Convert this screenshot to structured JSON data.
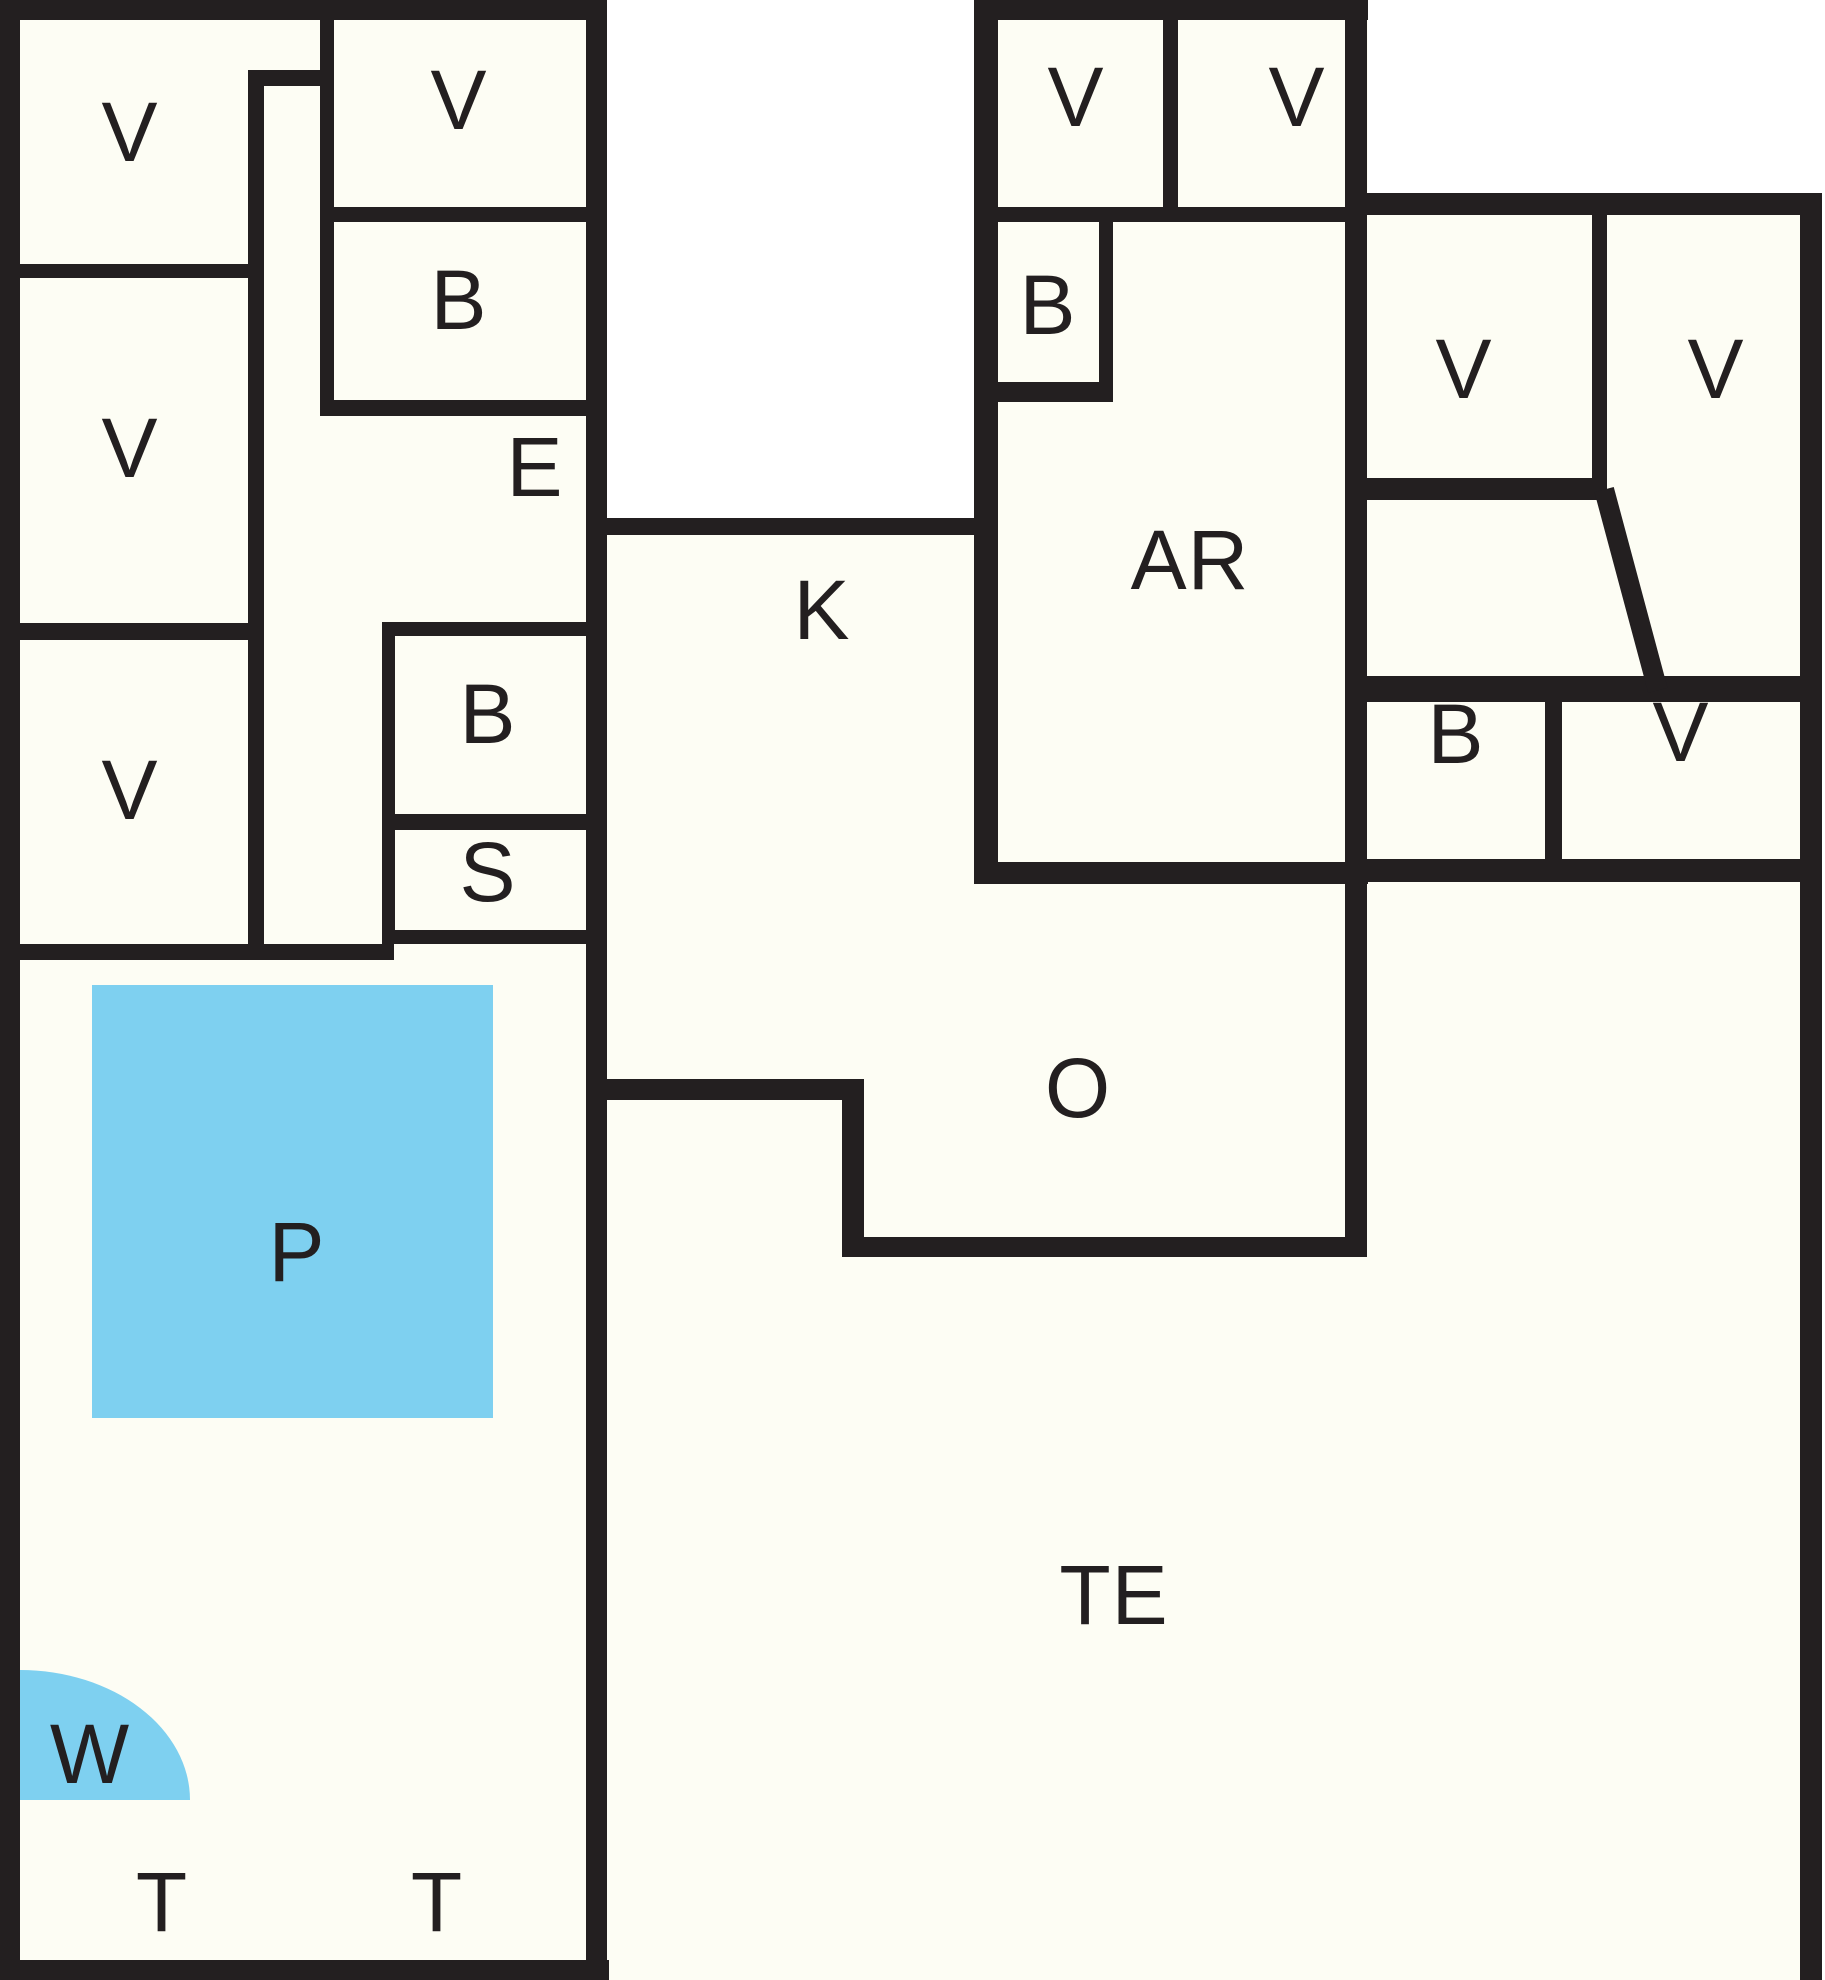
{
  "floor_plan": {
    "width": 1825,
    "height": 1980,
    "colors": {
      "wall": "#231f20",
      "room": "#fdfdf4",
      "outside": "#ffffff",
      "water": "#7ed0f0",
      "label": "#231f20"
    },
    "fills": [
      {
        "name": "left-block-area",
        "x": 0,
        "y": 0,
        "w": 607,
        "h": 1980
      },
      {
        "name": "k-o-area",
        "x": 607,
        "y": 535,
        "w": 738,
        "h": 722
      },
      {
        "name": "center-block-area",
        "x": 974,
        "y": 0,
        "w": 394,
        "h": 884
      },
      {
        "name": "right-wing-area",
        "x": 1345,
        "y": 193,
        "w": 477,
        "h": 689
      },
      {
        "name": "terrace-area",
        "x": 607,
        "y": 1079,
        "w": 1215,
        "h": 901
      },
      {
        "name": "terrace-right-area",
        "x": 1345,
        "y": 862,
        "w": 477,
        "h": 1118
      }
    ],
    "walls": [
      {
        "name": "outer-left",
        "x": 0,
        "y": 0,
        "w": 20,
        "h": 1980
      },
      {
        "name": "outer-top-left",
        "x": 0,
        "y": 0,
        "w": 607,
        "h": 20
      },
      {
        "name": "outer-top-center",
        "x": 974,
        "y": 0,
        "w": 394,
        "h": 20
      },
      {
        "name": "outer-right",
        "x": 1800,
        "y": 193,
        "w": 22,
        "h": 1787
      },
      {
        "name": "outer-bottom-left",
        "x": 0,
        "y": 1960,
        "w": 609,
        "h": 20
      },
      {
        "name": "main-spine",
        "x": 586,
        "y": 0,
        "w": 21,
        "h": 1980
      },
      {
        "name": "corridor-cap",
        "x": 248,
        "y": 70,
        "w": 84,
        "h": 16
      },
      {
        "name": "corridor-left",
        "x": 248,
        "y": 70,
        "w": 16,
        "h": 890
      },
      {
        "name": "corridor-right",
        "x": 320,
        "y": 20,
        "w": 14,
        "h": 396
      },
      {
        "name": "v1-bottom",
        "x": 17,
        "y": 264,
        "w": 246,
        "h": 14
      },
      {
        "name": "v2-bottom",
        "x": 17,
        "y": 623,
        "w": 246,
        "h": 17
      },
      {
        "name": "pool-room-top",
        "x": 17,
        "y": 944,
        "w": 377,
        "h": 16
      },
      {
        "name": "vmid-bottom",
        "x": 320,
        "y": 207,
        "w": 266,
        "h": 15
      },
      {
        "name": "bmid-bottom",
        "x": 320,
        "y": 400,
        "w": 287,
        "h": 16
      },
      {
        "name": "blower-top",
        "x": 382,
        "y": 622,
        "w": 225,
        "h": 14
      },
      {
        "name": "b-s-divider",
        "x": 382,
        "y": 814,
        "w": 225,
        "h": 16
      },
      {
        "name": "s-bottom",
        "x": 382,
        "y": 930,
        "w": 225,
        "h": 14
      },
      {
        "name": "b-s-left",
        "x": 382,
        "y": 622,
        "w": 13,
        "h": 322
      },
      {
        "name": "void-bottom",
        "x": 607,
        "y": 518,
        "w": 370,
        "h": 17
      },
      {
        "name": "ar-block-left",
        "x": 974,
        "y": 0,
        "w": 24,
        "h": 884
      },
      {
        "name": "va-vb-divider",
        "x": 1163,
        "y": 20,
        "w": 15,
        "h": 188
      },
      {
        "name": "center-v-bottom",
        "x": 998,
        "y": 207,
        "w": 347,
        "h": 15
      },
      {
        "name": "small-b-right",
        "x": 1099,
        "y": 222,
        "w": 14,
        "h": 160
      },
      {
        "name": "small-b-bottom",
        "x": 998,
        "y": 382,
        "w": 115,
        "h": 20
      },
      {
        "name": "ar-bottom",
        "x": 998,
        "y": 862,
        "w": 370,
        "h": 22
      },
      {
        "name": "block-right",
        "x": 1345,
        "y": 0,
        "w": 22,
        "h": 1257
      },
      {
        "name": "wing-top",
        "x": 1345,
        "y": 193,
        "w": 477,
        "h": 22
      },
      {
        "name": "wing-v-divider",
        "x": 1592,
        "y": 215,
        "w": 15,
        "h": 271
      },
      {
        "name": "wing-vleft-bottom",
        "x": 1345,
        "y": 478,
        "w": 262,
        "h": 22
      },
      {
        "name": "wing-row-top",
        "x": 1345,
        "y": 676,
        "w": 477,
        "h": 26
      },
      {
        "name": "wing-b-v-divider",
        "x": 1545,
        "y": 702,
        "w": 17,
        "h": 160
      },
      {
        "name": "wing-row-bottom",
        "x": 1345,
        "y": 859,
        "w": 477,
        "h": 23
      },
      {
        "name": "k-bottom-step",
        "x": 586,
        "y": 1079,
        "w": 278,
        "h": 21
      },
      {
        "name": "step-vertical",
        "x": 842,
        "y": 1100,
        "w": 22,
        "h": 157
      },
      {
        "name": "o-te-bottom",
        "x": 842,
        "y": 1237,
        "w": 525,
        "h": 20
      }
    ],
    "diagonal_wall": {
      "name": "wing-diagonal",
      "x": 1621,
      "y": 486,
      "w": 20,
      "h": 208,
      "rotate_deg": -15
    },
    "pool": {
      "label": "P",
      "x": 92,
      "y": 985,
      "w": 401,
      "h": 433,
      "label_x": 297,
      "label_y": 1252
    },
    "whirlpool": {
      "label": "W",
      "x": 20,
      "y": 1670,
      "w": 170,
      "h": 130,
      "label_x": 90,
      "label_y": 1754
    },
    "labels": [
      {
        "id": "room-label-v1",
        "text": "V",
        "x": 130,
        "y": 132
      },
      {
        "id": "room-label-v2",
        "text": "V",
        "x": 130,
        "y": 448
      },
      {
        "id": "room-label-v3",
        "text": "V",
        "x": 130,
        "y": 790
      },
      {
        "id": "room-label-v-mid",
        "text": "V",
        "x": 459,
        "y": 100
      },
      {
        "id": "room-label-b-mid",
        "text": "B",
        "x": 459,
        "y": 300
      },
      {
        "id": "room-label-e",
        "text": "E",
        "x": 535,
        "y": 467
      },
      {
        "id": "room-label-b-lower",
        "text": "B",
        "x": 488,
        "y": 714
      },
      {
        "id": "room-label-s",
        "text": "S",
        "x": 488,
        "y": 872
      },
      {
        "id": "room-label-k",
        "text": "K",
        "x": 822,
        "y": 610
      },
      {
        "id": "room-label-v-center-1",
        "text": "V",
        "x": 1076,
        "y": 97
      },
      {
        "id": "room-label-v-center-2",
        "text": "V",
        "x": 1297,
        "y": 97
      },
      {
        "id": "room-label-b-ar",
        "text": "B",
        "x": 1048,
        "y": 305
      },
      {
        "id": "room-label-ar",
        "text": "AR",
        "x": 1190,
        "y": 560
      },
      {
        "id": "room-label-v-wing-left",
        "text": "V",
        "x": 1464,
        "y": 369
      },
      {
        "id": "room-label-v-wing-right",
        "text": "V",
        "x": 1716,
        "y": 369
      },
      {
        "id": "room-label-b-wing",
        "text": "B",
        "x": 1456,
        "y": 734
      },
      {
        "id": "room-label-v-wing-row",
        "text": "V",
        "x": 1681,
        "y": 732
      },
      {
        "id": "room-label-o",
        "text": "O",
        "x": 1078,
        "y": 1088
      },
      {
        "id": "room-label-te",
        "text": "TE",
        "x": 1114,
        "y": 1595
      },
      {
        "id": "room-label-p",
        "text": "P",
        "x": 297,
        "y": 1252
      },
      {
        "id": "room-label-w",
        "text": "W",
        "x": 90,
        "y": 1754
      },
      {
        "id": "room-label-t1",
        "text": "T",
        "x": 162,
        "y": 1902
      },
      {
        "id": "room-label-t2",
        "text": "T",
        "x": 437,
        "y": 1902
      }
    ]
  }
}
